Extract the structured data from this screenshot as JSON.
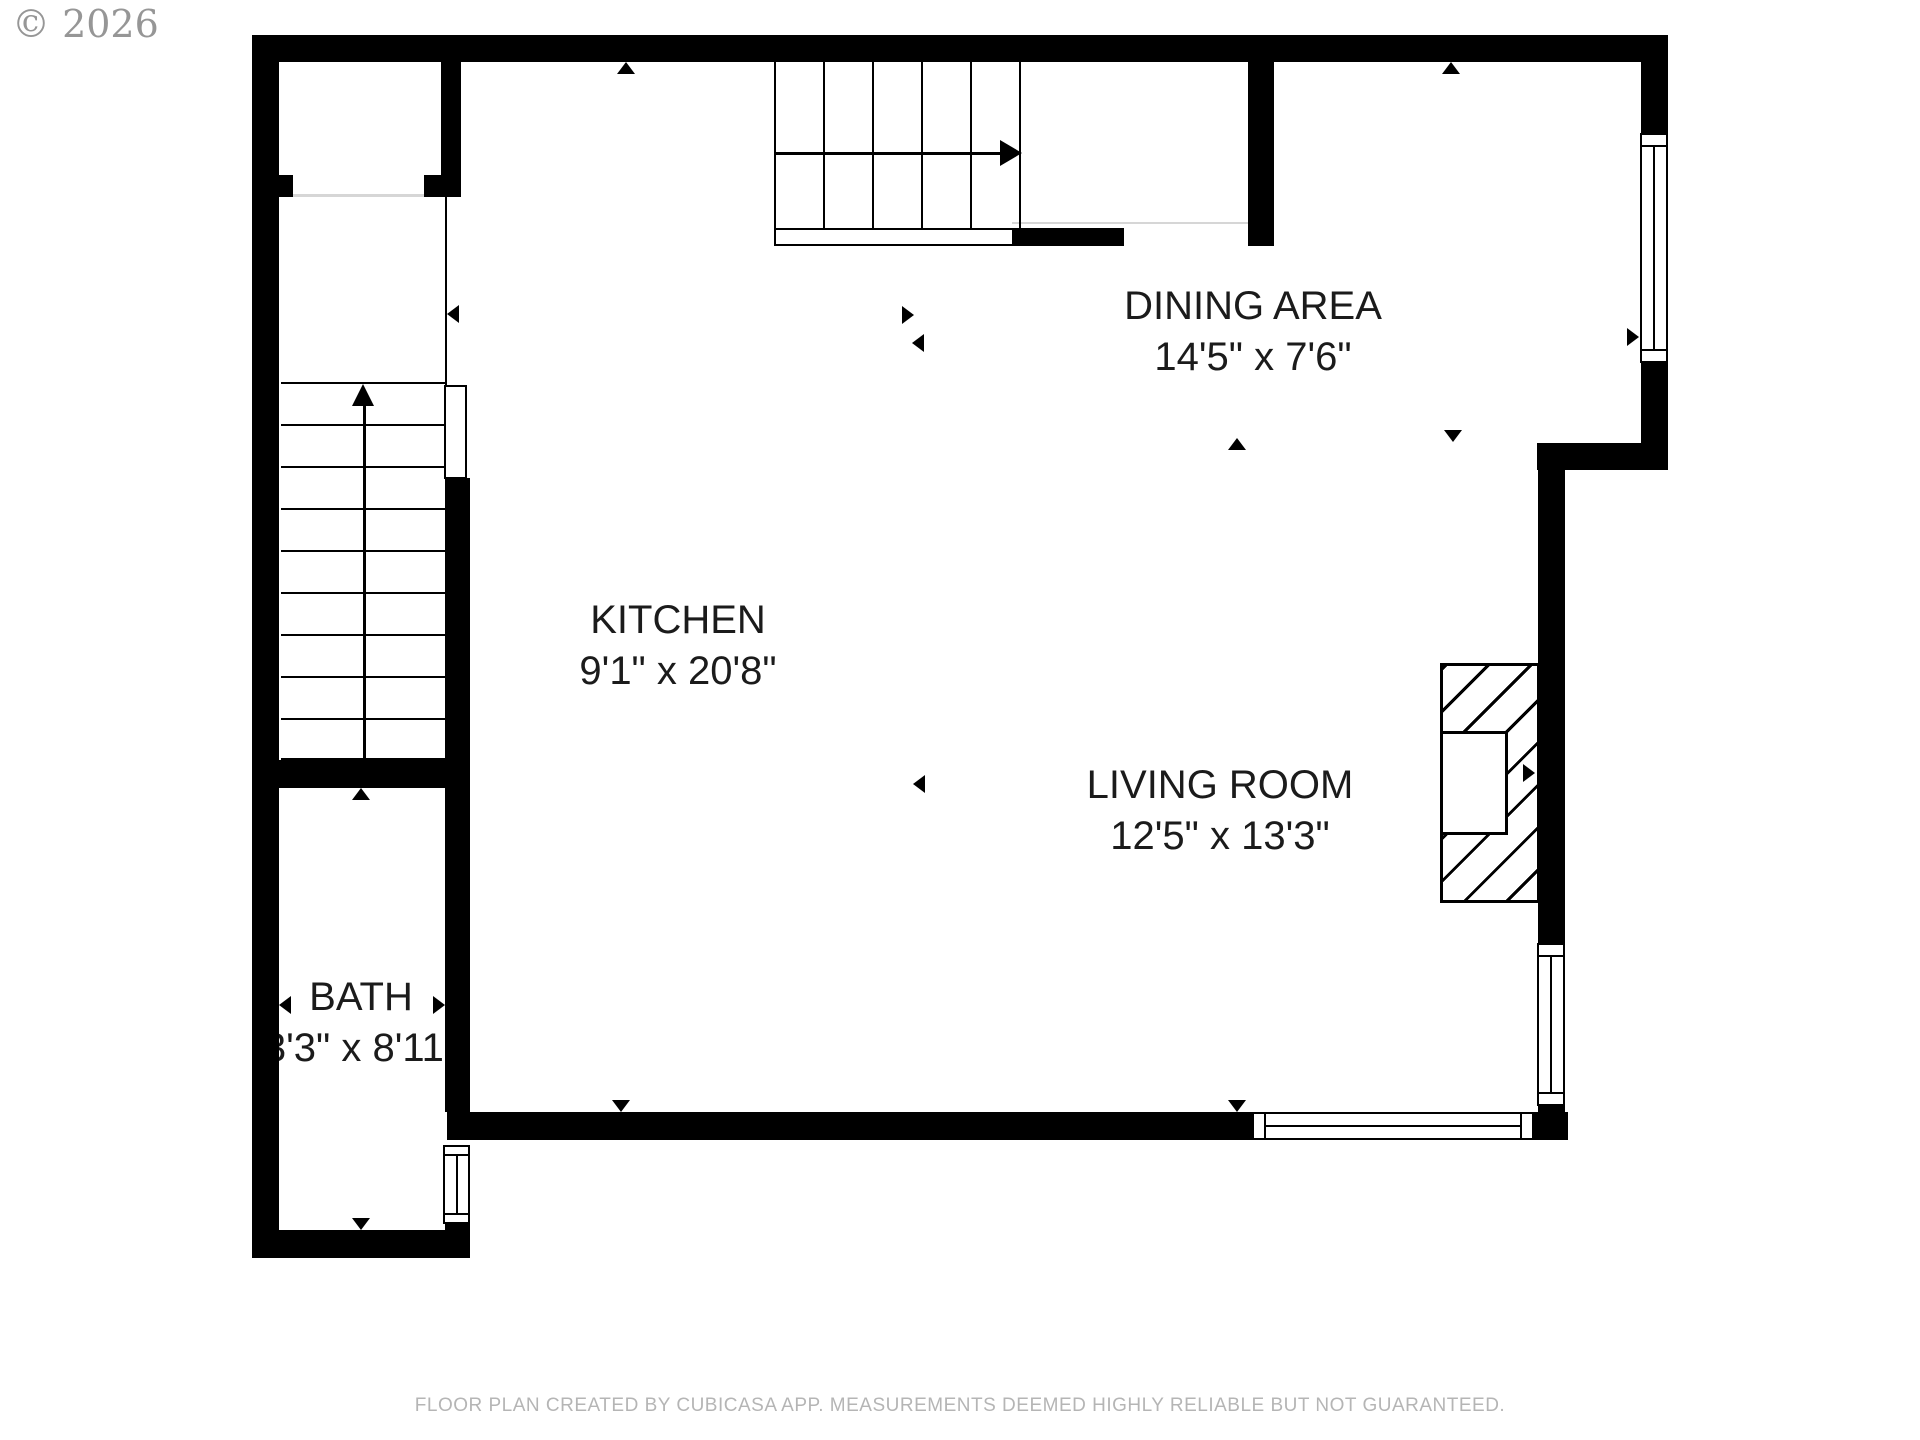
{
  "watermark": "© 2026",
  "footer": "FLOOR PLAN CREATED BY CUBICASA APP. MEASUREMENTS DEEMED HIGHLY RELIABLE BUT NOT GUARANTEED.",
  "rooms": {
    "dining": {
      "name": "DINING AREA",
      "dims": "14'5\" x 7'6\""
    },
    "kitchen": {
      "name": "KITCHEN",
      "dims": "9'1\" x 20'8\""
    },
    "living": {
      "name": "LIVING ROOM",
      "dims": "12'5\" x 13'3\""
    },
    "bath": {
      "name": "BATH",
      "dims": "3'3\" x 8'11\""
    }
  },
  "colors": {
    "wall": "#000000",
    "label_text": "#1b1b1b",
    "footer_text": "#b5b5b5",
    "watermark_text": "#969696",
    "door_opening_line": "#d6d6d6"
  }
}
